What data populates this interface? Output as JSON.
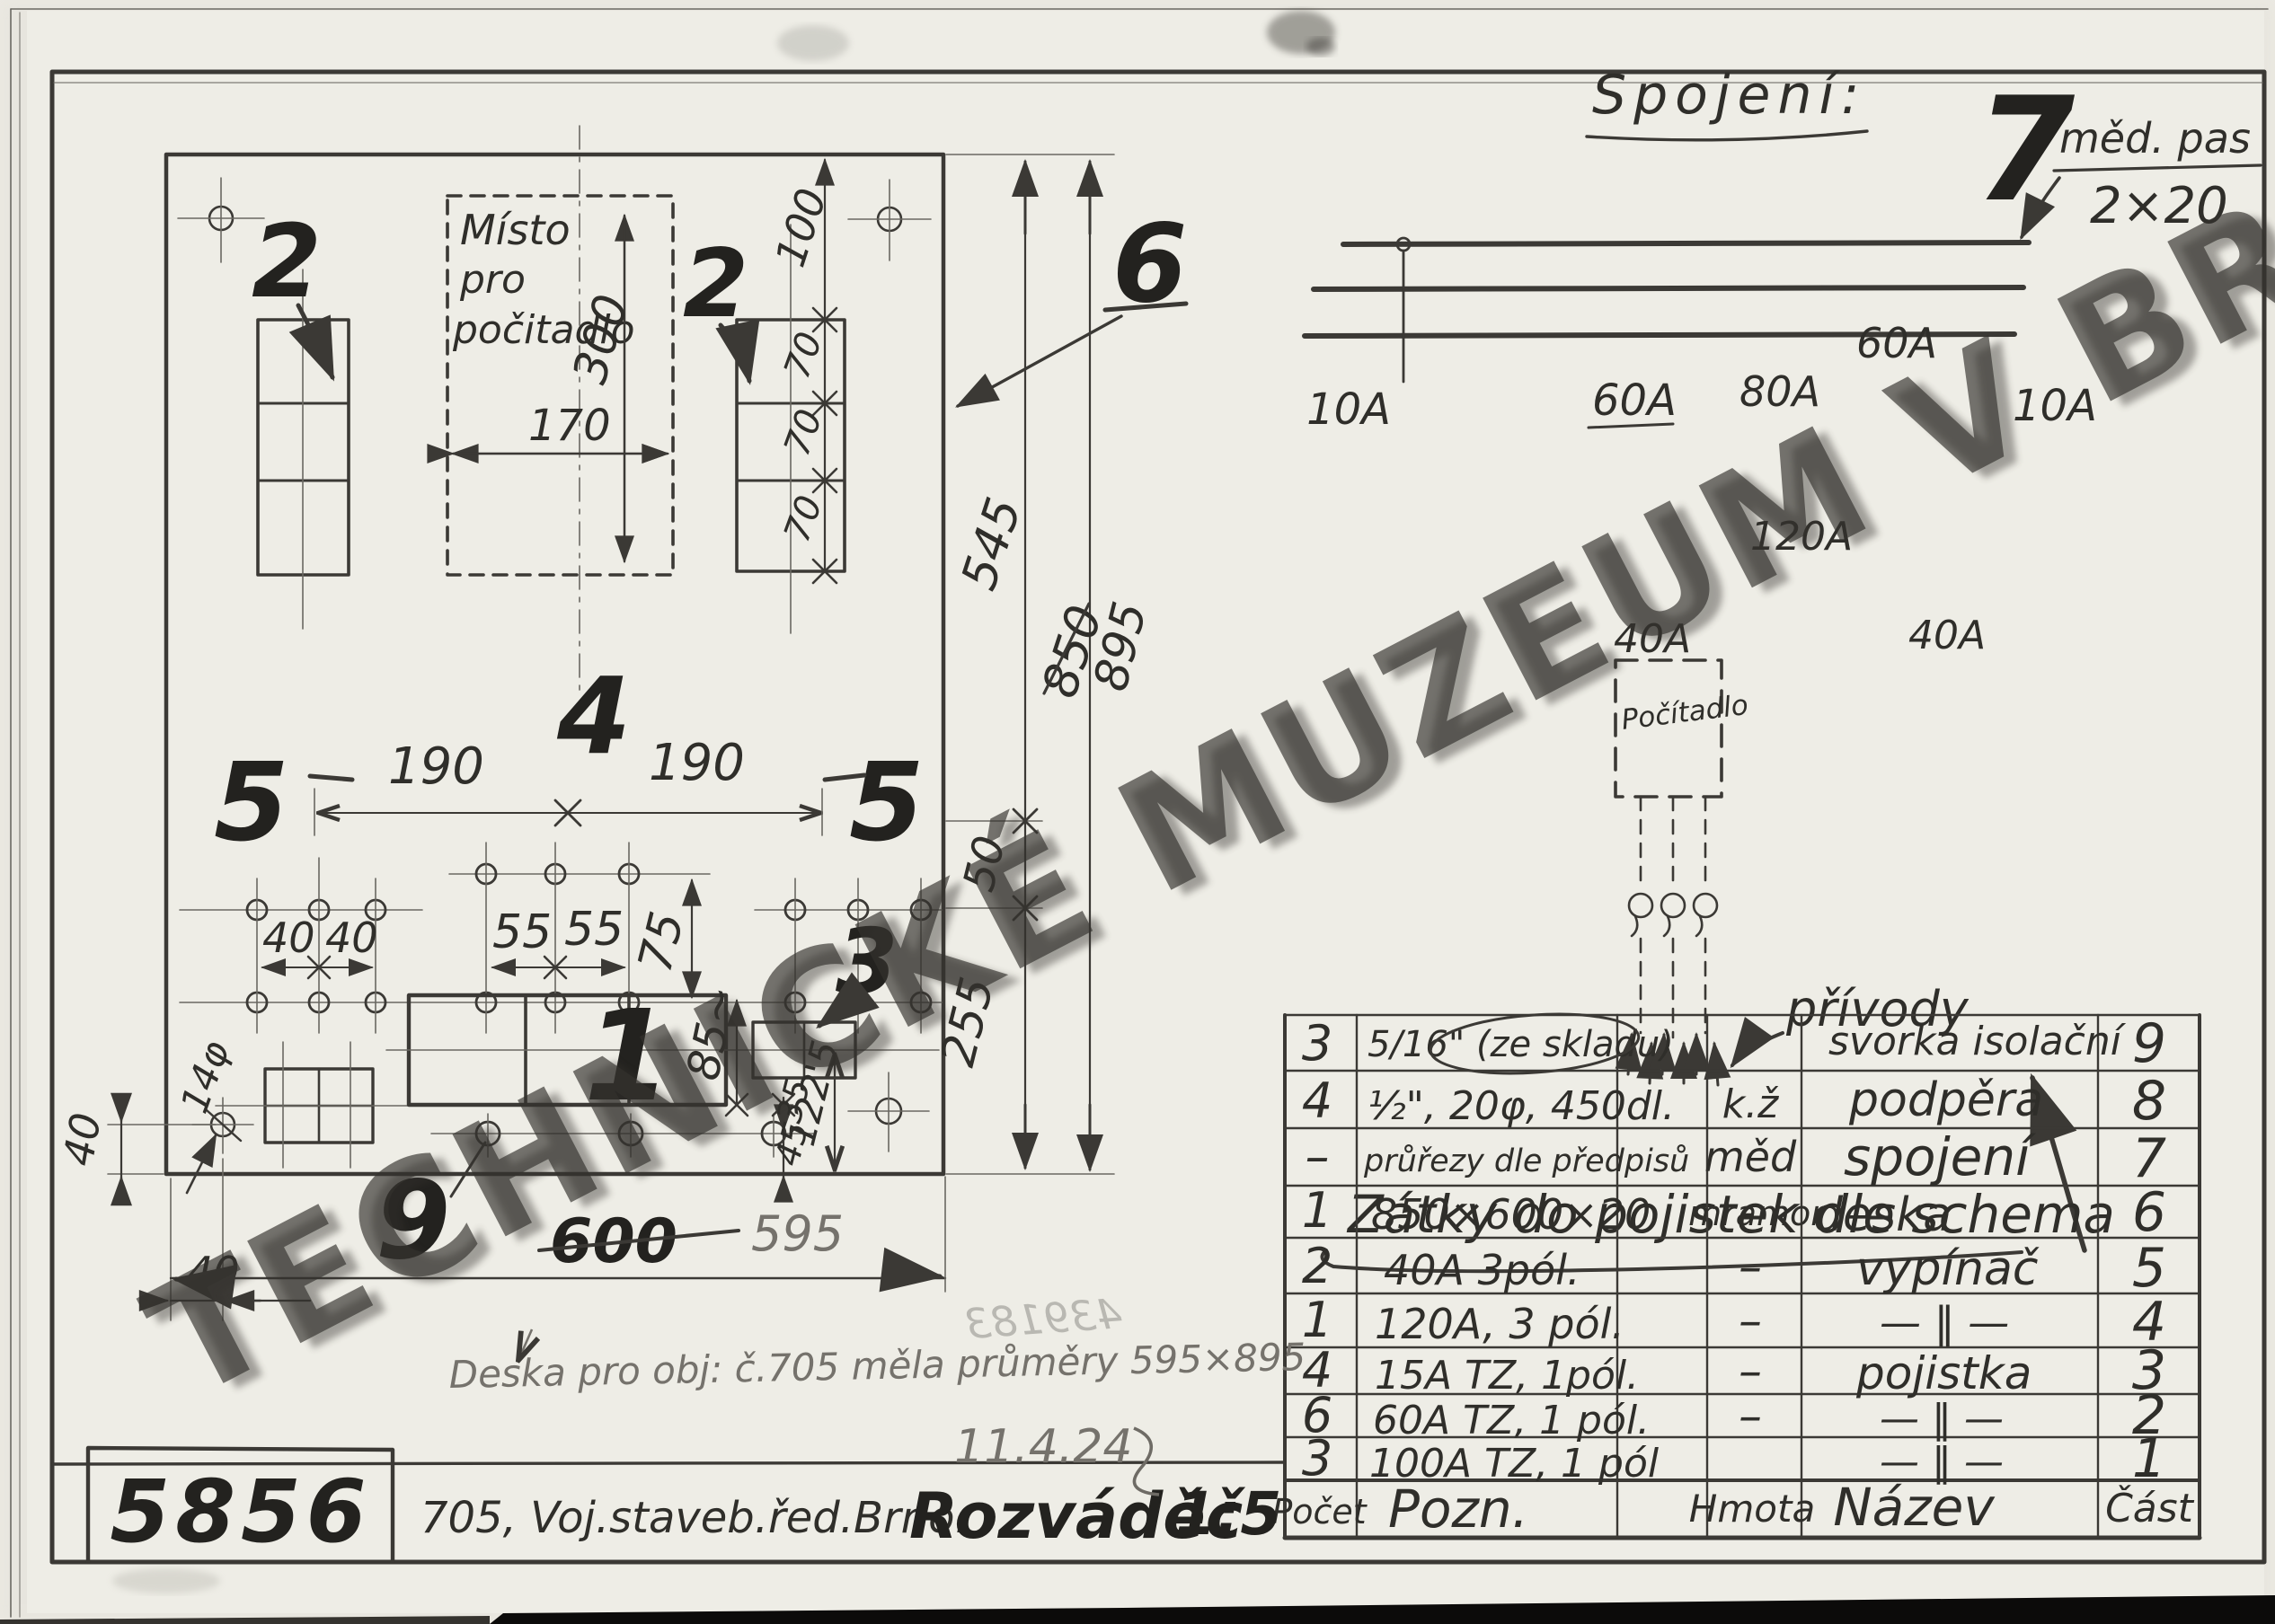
{
  "sheet": {
    "watermark": "TECHNICKÉ MUZEUM V BRNĚ",
    "drawing_number": "5856",
    "org": "705, Voj.staveb.řed.Brno.",
    "title": "Rozváděč",
    "scale": "1:5",
    "pencil_note": "Deska pro obj: č.705  měla průměry 595×895",
    "pencil_date": "11.4.24",
    "stamp_faint": "439183"
  },
  "plan": {
    "counter_area": {
      "l1": "Místo",
      "l2": "pro",
      "l3": "počitadlo"
    },
    "labels": {
      "pos1": "1",
      "pos2l": "2",
      "pos2r": "2",
      "pos3": "3",
      "pos4": "4",
      "pos5l": "5",
      "pos5r": "5",
      "pos6": "6",
      "pos9": "9"
    },
    "dims": {
      "d100": "100",
      "d300": "300",
      "d170": "170",
      "d70a": "70",
      "d70b": "70",
      "d70c": "70",
      "d190a": "190",
      "d190b": "190",
      "d40a": "40",
      "d40b": "40",
      "d55a": "55",
      "d55b": "55",
      "d75": "75",
      "d50": "50",
      "d545": "545",
      "d850": "850",
      "d895": "895",
      "d255": "255",
      "d85": "85~",
      "d35": "35",
      "d45": "45",
      "d1225": "122'5",
      "d14": "14φ",
      "d40left": "40",
      "d40bottom": "40",
      "d600": "600",
      "d595": "595"
    }
  },
  "schematic": {
    "heading": "Spojení:",
    "pos7": "7",
    "bus_note1": "měd. pas",
    "bus_note2": "2×20",
    "fuse10a_l": "10A",
    "fuse60a_l": "60A",
    "fuse80a": "80A",
    "fuse60a_r": "60A",
    "fuse10a_r": "10A",
    "sw40_l": "40A",
    "sw120": "120A",
    "sw40_r": "40A",
    "counter": "Počítadlo",
    "feeds": "přívody",
    "note": "Zátky do pojistek  dle schema"
  },
  "table": {
    "headers": [
      "Počet",
      "Pozn.",
      "",
      "Hmota",
      "Název",
      "Část"
    ],
    "rows": [
      [
        "3",
        "5/16\" (ze skladu)",
        "",
        "svorka isolační",
        "9"
      ],
      [
        "4",
        "½\", 20φ, 450dl.",
        "k.ž",
        "podpěra",
        "8"
      ],
      [
        "–",
        "průřezy dle předpisů",
        "měd",
        "spojení",
        "7"
      ],
      [
        "1",
        "850×600×20",
        "mramor",
        "deska",
        "6"
      ],
      [
        "2",
        "40A 3pól.",
        "–",
        "vypínač",
        "5"
      ],
      [
        "1",
        "120A, 3 pól.",
        "–",
        "— ‖ —",
        "4"
      ],
      [
        "4",
        "15A TZ, 1pól.",
        "–",
        "pojistka",
        "3"
      ],
      [
        "6",
        "60A TZ, 1 pól.",
        "–",
        "— ‖ —",
        "2"
      ],
      [
        "3",
        "100A TZ, 1 pól",
        "",
        "— ‖ —",
        "1"
      ]
    ]
  }
}
